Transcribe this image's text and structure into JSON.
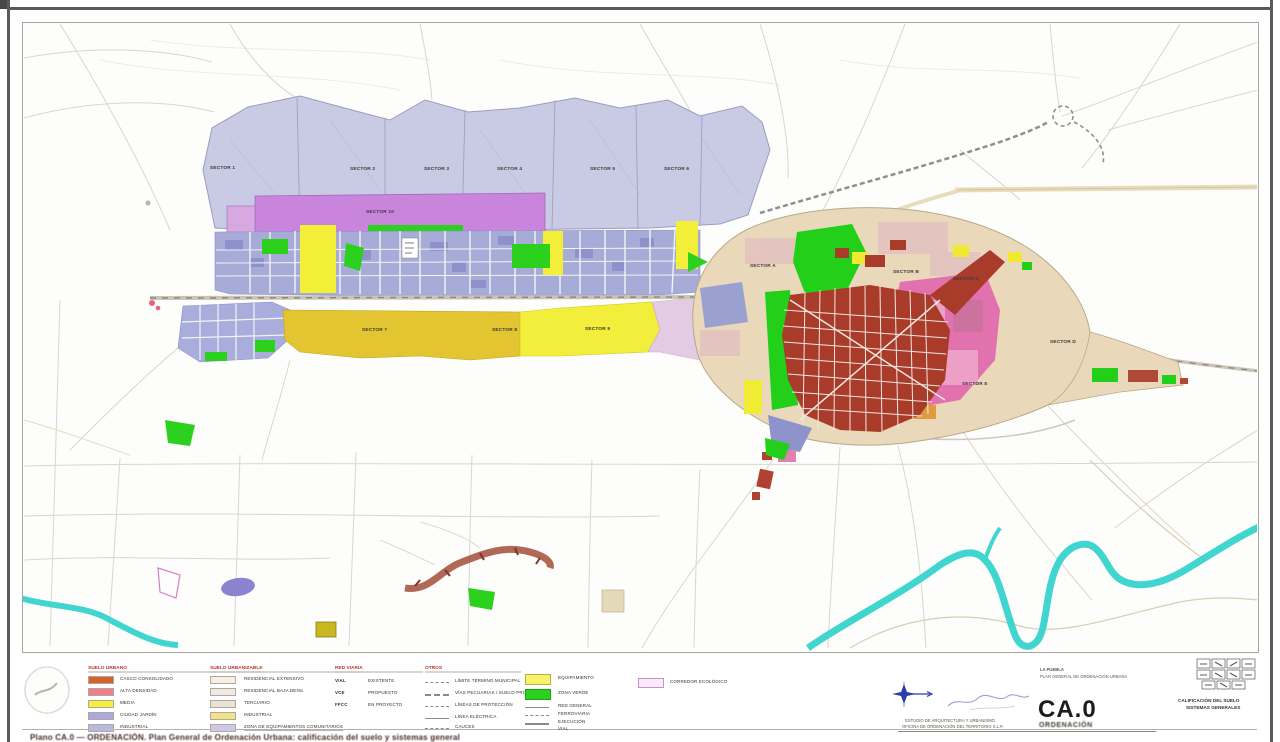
{
  "page": {
    "caption": "Plano CA.0 — ORDENACIÓN. Plan General de Ordenación Urbana: calificación del suelo y sistemas generales."
  },
  "map": {
    "sector_top": [
      "SECTOR 1",
      "SECTOR 2",
      "SECTOR 3",
      "SECTOR 4",
      "SECTOR 5",
      "SECTOR 6"
    ],
    "sector_mid": [
      "SECTOR 7",
      "SECTOR 8",
      "SECTOR 9",
      "SECTOR 10"
    ],
    "sector_town": [
      "SECTOR A",
      "SECTOR B",
      "SECTOR C",
      "SECTOR D",
      "SECTOR E"
    ]
  },
  "legend": {
    "urban": {
      "header": "SUELO URBANO",
      "items": [
        {
          "label": "CASCO CONSOLIDADO",
          "color": "#d4622a"
        },
        {
          "label": "ALTA DENSIDAD",
          "color": "#ef7f8a"
        },
        {
          "label": "MEDIA",
          "color": "#f6ef39"
        },
        {
          "label": "CIUDAD JARDÍN",
          "color": "#a9abdc"
        },
        {
          "label": "INDUSTRIAL",
          "color": "#b9badf"
        }
      ]
    },
    "urbanizable": {
      "header": "SUELO URBANIZABLE",
      "items": [
        {
          "label": "RESIDENCIAL EXTENSIVO",
          "color": "#f7efe2"
        },
        {
          "label": "RESIDENCIAL BAJA DENS.",
          "color": "#f3e9e4"
        },
        {
          "label": "TERCIARIO",
          "color": "#eae1d3"
        },
        {
          "label": "INDUSTRIAL",
          "color": "#efe388"
        },
        {
          "label": "ZONA DE EQUIPAMIENTOS COMUNITARIOS",
          "color": "#cbc8e8"
        }
      ]
    },
    "viario": {
      "header": "RED VIARIA",
      "items": [
        {
          "code": "VIAL",
          "label": "EXISTENTE"
        },
        {
          "code": "VCE",
          "label": "PROPUESTO"
        },
        {
          "code": "FFCC",
          "label": "EN PROYECTO"
        }
      ]
    },
    "otros": {
      "header": "OTROS",
      "items": [
        {
          "label": "LÍMITE TÉRMINO MUNICIPAL"
        },
        {
          "label": "VÍAS PECUARIAS / SUELO PROTEGIDO"
        },
        {
          "label": "LÍNEAS DE PROTECCIÓN"
        },
        {
          "label": "LÍNEA ELÉCTRICA"
        },
        {
          "label": "CAUCES"
        }
      ]
    },
    "sistemas": {
      "items": [
        {
          "label": "EQUIPAMIENTO",
          "color": "#f6f26a"
        },
        {
          "label": "ZONA VERDE",
          "color": "#2bd11c"
        },
        {
          "label": "RED GENERAL"
        },
        {
          "label": "FERROVIARIA"
        },
        {
          "label": "EJECUCIÓN"
        },
        {
          "label": "VIAL"
        }
      ]
    },
    "corridor": {
      "label": "CORREDOR ECOLÓGICO",
      "border_color": "#cc8fcc"
    }
  },
  "title_block": {
    "project_line1": "LA PUEBLA",
    "project_line2": "PLAN GENERAL DE ORDENACIÓN URBANA",
    "plan_code": "CA.0",
    "plan_code_sub": "ORDENACIÓN",
    "consultant_line1": "ESTUDIO DE ARQUITECTURA Y URBANISMO",
    "consultant_line2": "OFICINA DE ORDENACIÓN DEL TERRITORIO S.L.P.",
    "right_title_line1": "CALIFICACIÓN DEL SUELO",
    "right_title_line2": "SISTEMAS GENERALES"
  },
  "colors": {
    "sector_band": "#c9cae4",
    "orchid_zone": "#c985dc",
    "industrial_band": "#a7abd8",
    "gold_sector": "#e3c531",
    "yellow_sector": "#f2ee3b",
    "town_ring": "#e9d9ba",
    "urban_core_red": "#a93b2a",
    "pink_zone": "#e066ae",
    "green_zone": "#22cf19",
    "river_cyan": "#40d6cf"
  }
}
